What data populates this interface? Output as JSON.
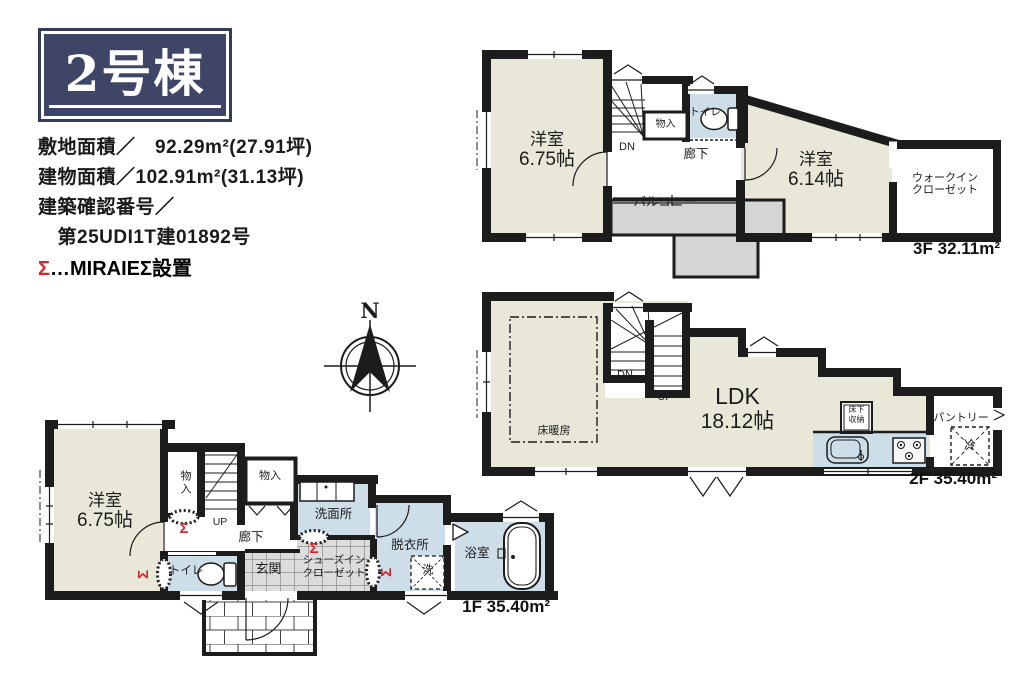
{
  "header": {
    "building_title": "2号棟",
    "info_lines": [
      "敷地面積／　92.29m²(27.91坪)",
      "建物面積／102.91m²(31.13坪)",
      "建築確認番号／",
      "　第25UDI1T建01892号"
    ],
    "legend_sigma": "Σ",
    "legend_rest": "…MIRAIEΣ設置"
  },
  "compass": {
    "north": "N"
  },
  "colors": {
    "title_navy": "#3e4566",
    "room_beige": "#e9e8d8",
    "wet_area_blue": "#cddee9",
    "balcony_gray": "#d4d5d7",
    "sigma_red": "#d8242b",
    "wall_black": "#1c1c1c"
  },
  "floor3": {
    "area_label": "3F 32.11m²",
    "bedroom1_name": "洋室",
    "bedroom1_size": "6.75帖",
    "stair_down": "DN",
    "storage": "物入",
    "toilet": "トイレ",
    "hallway": "廊下",
    "bedroom2_name": "洋室",
    "bedroom2_size": "6.14帖",
    "wic_line1": "ウォークイン",
    "wic_line2": "クローゼット",
    "balcony": "バルコニー"
  },
  "floor2": {
    "area_label": "2F 35.40m²",
    "stair_down": "DN",
    "stair_up": "UP",
    "ldk_name": "LDK",
    "ldk_size": "18.12帖",
    "floor_heating": "床暖房",
    "underfloor_line1": "床下",
    "underfloor_line2": "収納",
    "pantry": "パントリー",
    "fridge": "冷"
  },
  "floor1": {
    "area_label": "1F 35.40m²",
    "bedroom_name": "洋室",
    "bedroom_size": "6.75帖",
    "storage1": "物入",
    "storage2": "物入",
    "stair_up": "UP",
    "hallway": "廊下",
    "washroom": "洗面所",
    "dressing_room": "脱衣所",
    "laundry": "洗",
    "bathroom": "浴室",
    "toilet": "トイレ",
    "entrance": "玄関",
    "shoe_closet_line1": "シューズイン",
    "shoe_closet_line2": "クローゼット",
    "sigma": "Σ"
  }
}
